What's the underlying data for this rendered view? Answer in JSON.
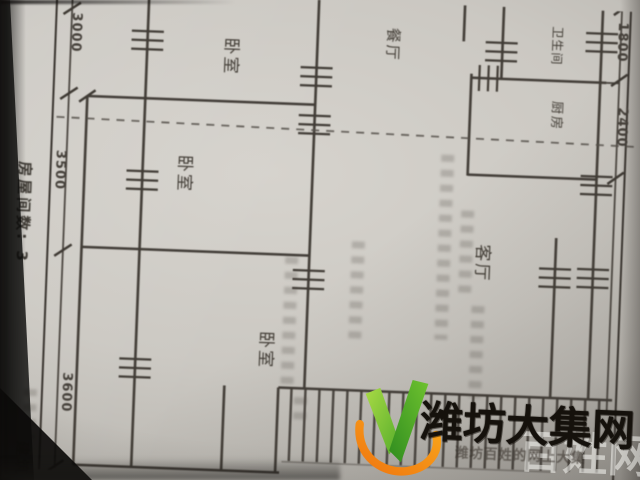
{
  "photo": {
    "description": "photograph of a printed apartment floor-plan form",
    "paper_color": "#cbc8c2",
    "line_color": "#423d37"
  },
  "form": {
    "rooms_count_label": "房屋间数: 3",
    "building_label": "建筑"
  },
  "rooms": [
    {
      "id": "bedroom-top",
      "label": "卧室"
    },
    {
      "id": "bedroom-middle",
      "label": "卧室"
    },
    {
      "id": "bedroom-bottom",
      "label": "卧室"
    },
    {
      "id": "dining-room",
      "label": "餐厅"
    },
    {
      "id": "bathroom",
      "label": "卫生间"
    },
    {
      "id": "kitchen",
      "label": "厨房"
    },
    {
      "id": "living-room",
      "label": "客厅"
    }
  ],
  "dimensions": {
    "left": [
      "3000",
      "3500",
      "3600"
    ],
    "right": [
      "1800",
      "2400"
    ]
  },
  "watermark": {
    "brand": "潍坊大集网",
    "overlay": "百姓网",
    "tagline": "潍坊百姓的网上大集",
    "colors": {
      "leaf_light": "#9ed33c",
      "leaf_dark": "#2f8c1f",
      "swoosh": "#f5921e",
      "text": "#15110c"
    }
  }
}
